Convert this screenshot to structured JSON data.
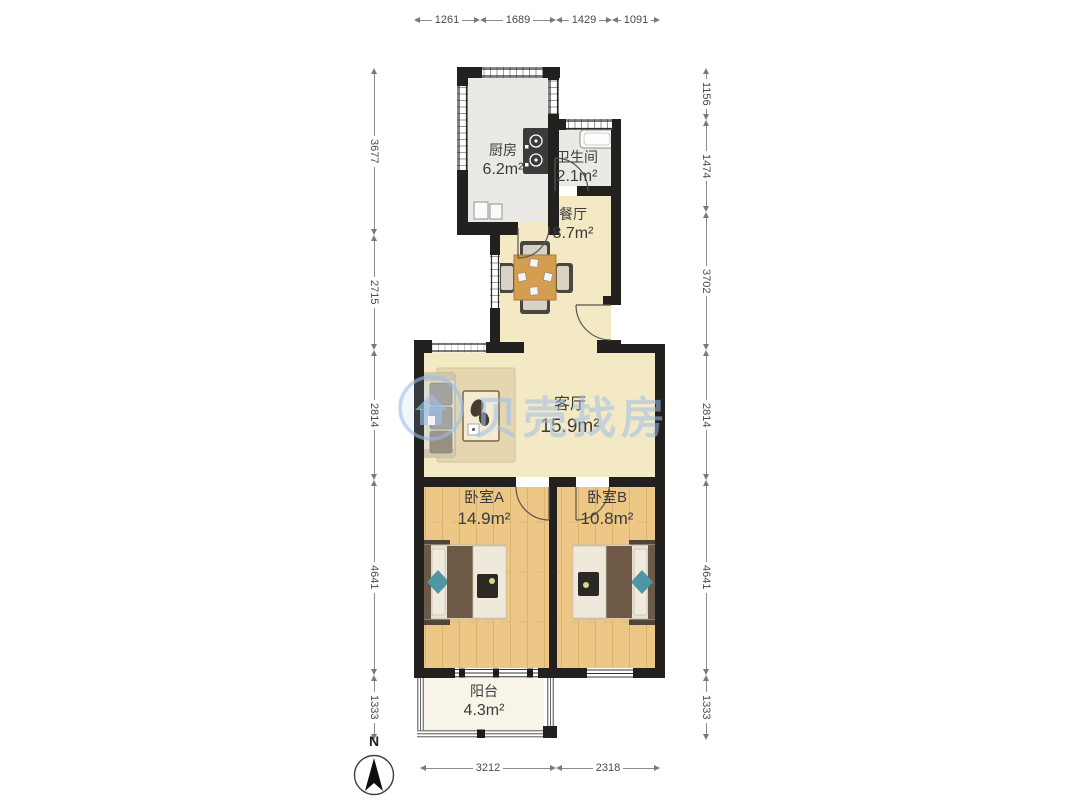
{
  "watermark": {
    "text": "贝壳找房",
    "color": "#9DBFE9"
  },
  "compass": {
    "label": "N"
  },
  "rooms": {
    "kitchen": {
      "name": "厨房",
      "area": "6.2m²"
    },
    "bathroom": {
      "name": "卫生间",
      "area": "2.1m²"
    },
    "dining": {
      "name": "餐厅",
      "area": "8.7m²"
    },
    "living": {
      "name": "客厅",
      "area": "15.9m²"
    },
    "bedroom_a": {
      "name": "卧室A",
      "area": "14.9m²"
    },
    "bedroom_b": {
      "name": "卧室B",
      "area": "10.8m²"
    },
    "balcony": {
      "name": "阳台",
      "area": "4.3m²"
    }
  },
  "dimensions": {
    "top": [
      "1261",
      "1689",
      "1429",
      "1091"
    ],
    "left": [
      "3677",
      "2715",
      "2814",
      "4641",
      "1333"
    ],
    "right": [
      "1156",
      "1474",
      "3702",
      "2814",
      "4641",
      "1333"
    ],
    "bottom": [
      "3212",
      "2318"
    ]
  },
  "palette": {
    "wall": "#232120",
    "floor_wood": "#EDC786",
    "floor_cream": "#F3E9C4",
    "floor_gray": "#EAE9E5",
    "floor_balcony": "#F8F4E8"
  }
}
